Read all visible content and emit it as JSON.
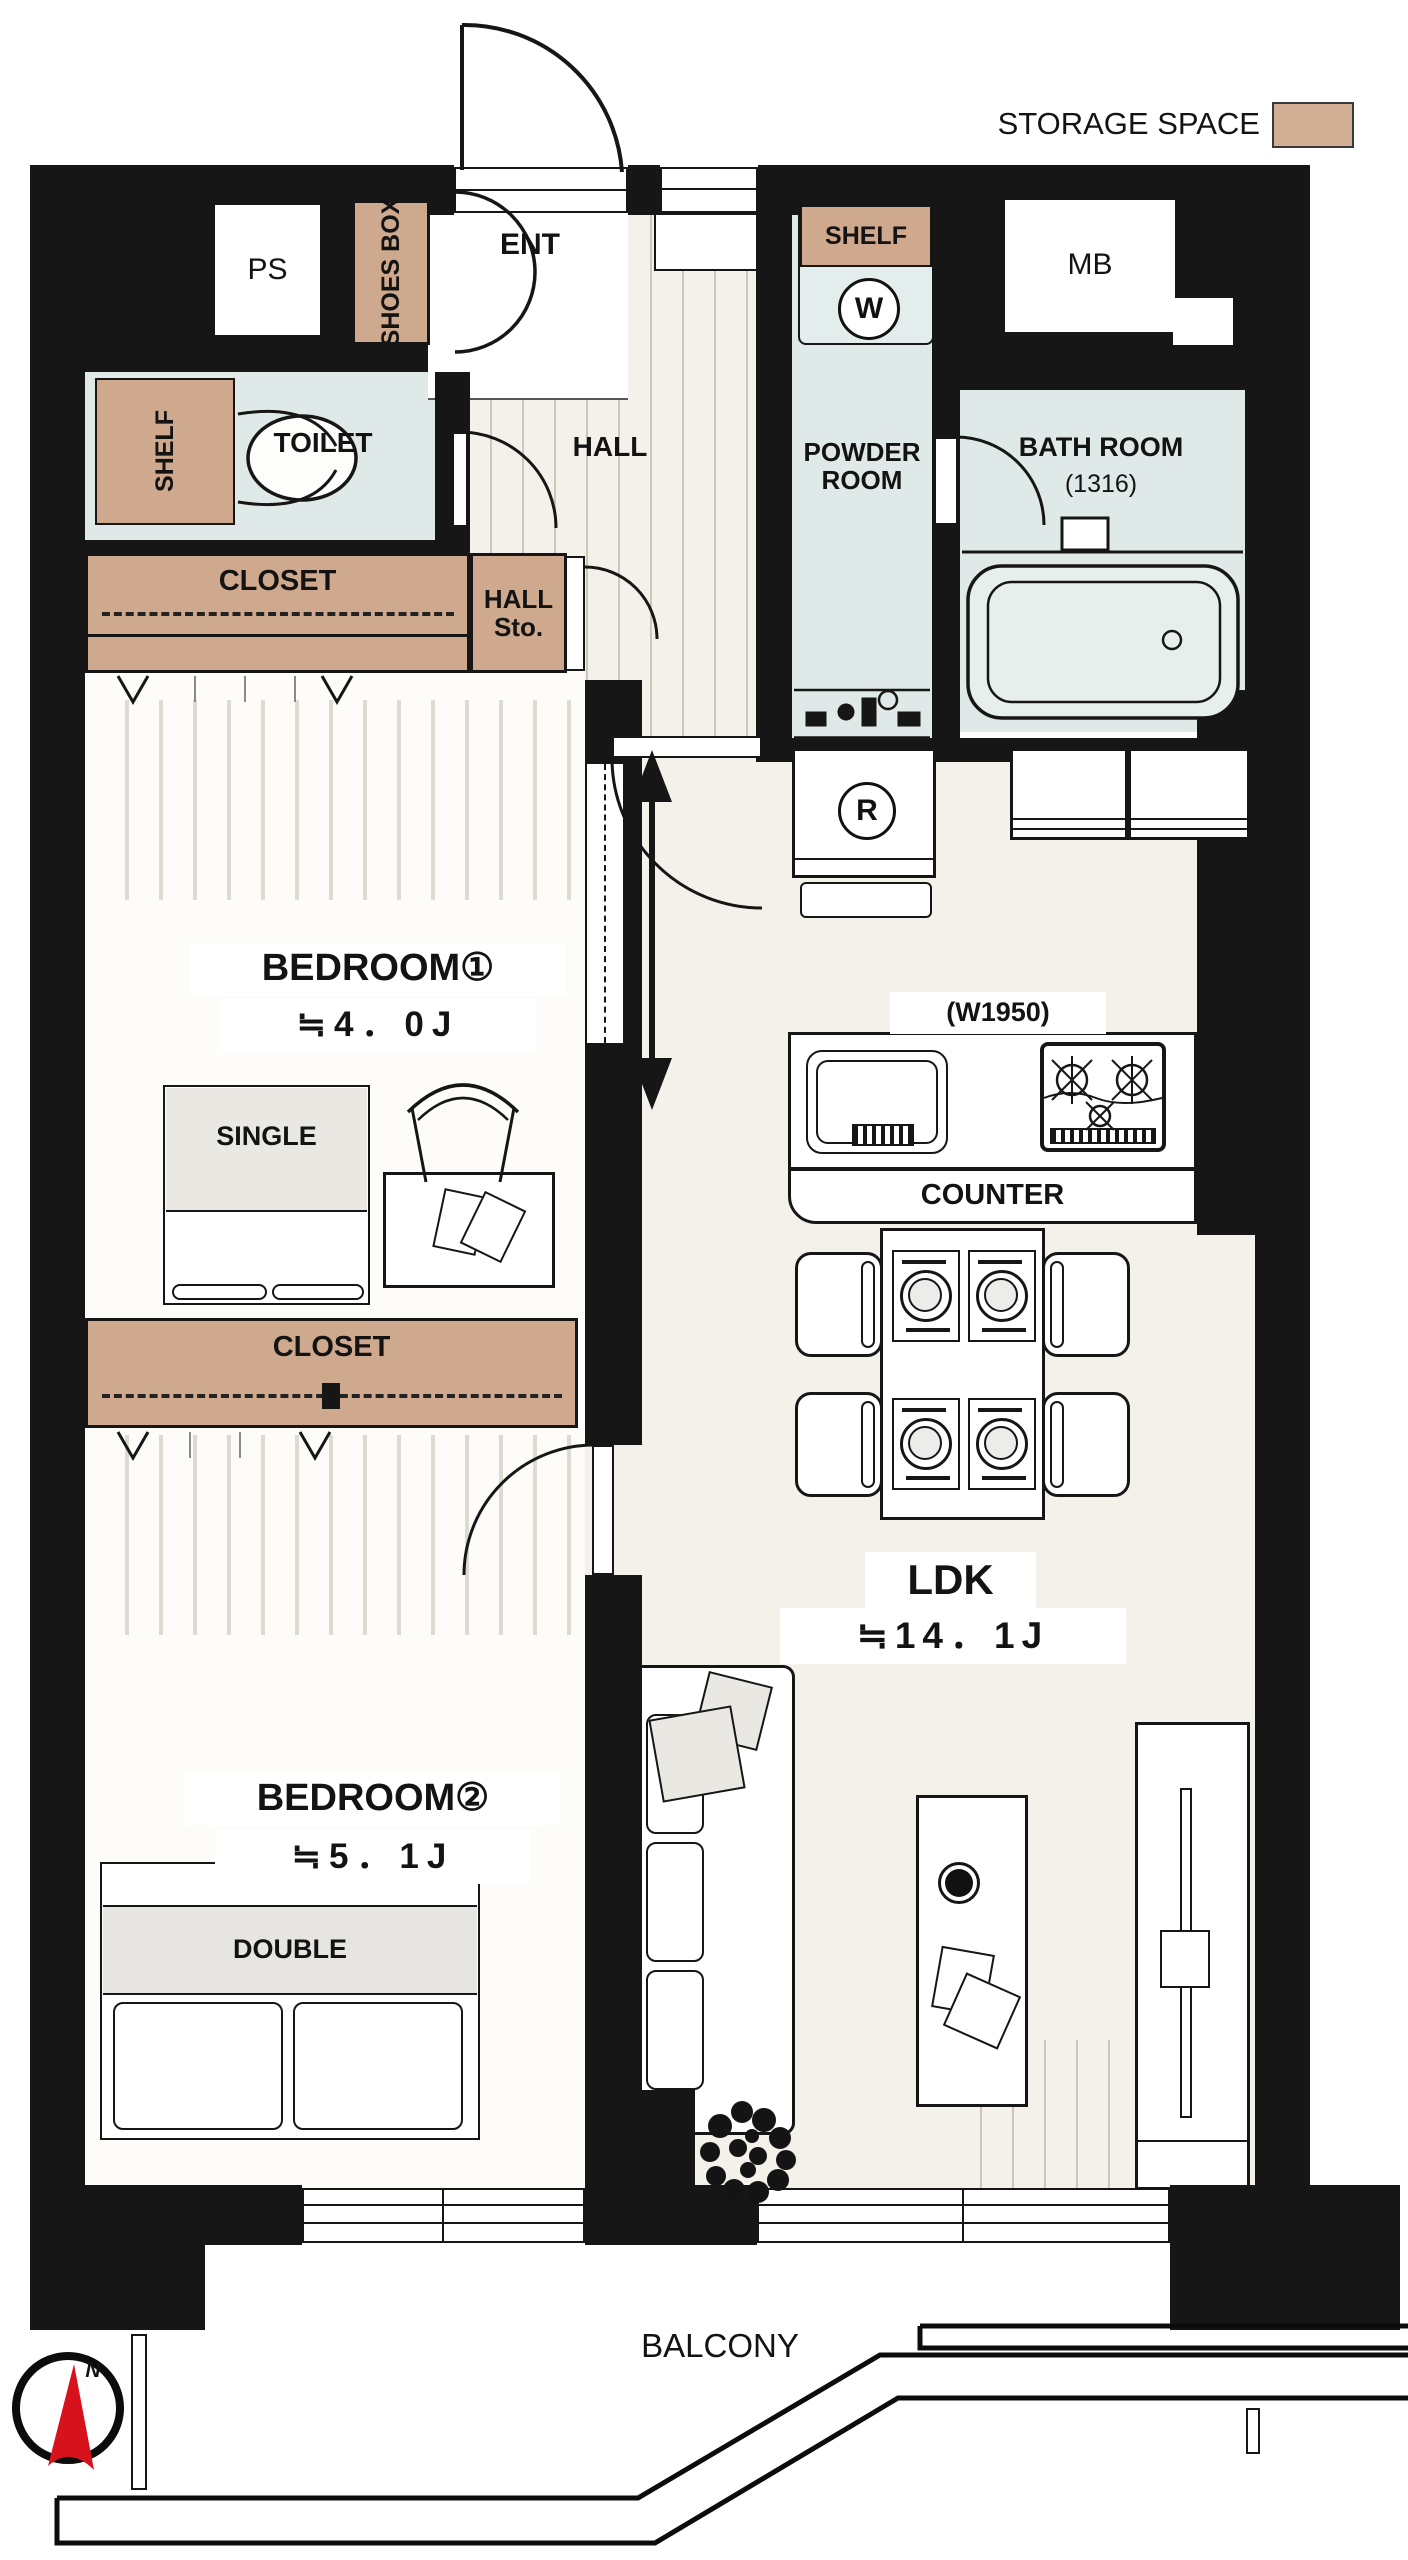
{
  "legend": {
    "label": "STORAGE SPACE",
    "swatch_color": "#D2AF94"
  },
  "colors": {
    "wall": "#161616",
    "storage": "#CFA98E",
    "wet_area": "#DFE9E7",
    "ldk_floor": "#F3F1E9",
    "bedroom_floor": "#FDFCF8",
    "compass_red": "#D8121C"
  },
  "entrance": {
    "ps": "PS",
    "shoes_box": "SHOES BOX",
    "ent": "ENT",
    "mb": "MB"
  },
  "hall": {
    "label": "HALL",
    "storage": "HALL Sto."
  },
  "toilet": {
    "label": "TOILET",
    "shelf": "SHELF"
  },
  "powder": {
    "label": "POWDER ROOM",
    "shelf": "SHELF",
    "washer": "W"
  },
  "bath": {
    "label": "BATH ROOM",
    "size": "(1316)"
  },
  "closet1": {
    "label": "CLOSET"
  },
  "closet2": {
    "label": "CLOSET"
  },
  "bedroom1": {
    "name": "BEDROOM①",
    "area": "≒4．0J",
    "bed": "SINGLE"
  },
  "bedroom2": {
    "name": "BEDROOM②",
    "area": "≒5．1J",
    "bed": "DOUBLE"
  },
  "ldk": {
    "name": "LDK",
    "area": "≒14．1J"
  },
  "kitchen": {
    "width_label": "(W1950)",
    "counter": "COUNTER",
    "fridge": "R"
  },
  "balcony": {
    "label": "BALCONY"
  },
  "compass": {
    "north": "N"
  }
}
